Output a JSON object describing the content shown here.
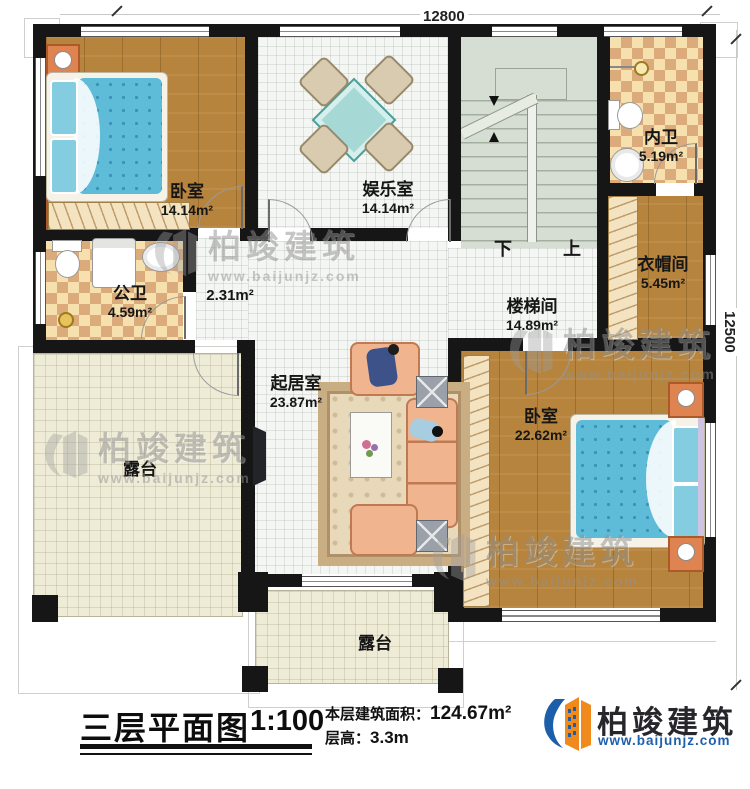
{
  "dimensions": {
    "top": "12800",
    "right": "12500"
  },
  "rooms": {
    "bedroom1": {
      "name": "卧室",
      "area": "14.14m²"
    },
    "entertainment": {
      "name": "娱乐室",
      "area": "14.14m²"
    },
    "inner_bath": {
      "name": "内卫",
      "area": "5.19m²"
    },
    "cloakroom": {
      "name": "衣帽间",
      "area": "5.45m²"
    },
    "stairwell": {
      "name": "楼梯间",
      "area": "14.89m²"
    },
    "hallway": {
      "area": "2.31m²"
    },
    "public_bath": {
      "name": "公卫",
      "area": "4.59m²"
    },
    "living": {
      "name": "起居室",
      "area": "23.87m²"
    },
    "bedroom2": {
      "name": "卧室",
      "area": "22.62m²"
    },
    "terrace_left": {
      "name": "露台"
    },
    "terrace_bottom": {
      "name": "露台"
    }
  },
  "stairs": {
    "down": "下",
    "up": "上"
  },
  "title_block": {
    "title": "三层平面图",
    "scale": "1:100",
    "floor_area_label": "本层建筑面积：",
    "floor_area_value": "124.67m²",
    "floor_height_label": "层高：",
    "floor_height_value": "3.3m"
  },
  "brand": {
    "name": "柏竣建筑",
    "website": "www.baijunjz.com"
  },
  "watermark": {
    "name": "柏竣建筑",
    "website": "www.baijunjz.com"
  },
  "colors": {
    "wall": "#161616",
    "wood": "#b6843d",
    "bed_blue": "#5fbcd8",
    "brand_blue": "#1c5ea9",
    "brand_orange": "#f18a1c"
  }
}
